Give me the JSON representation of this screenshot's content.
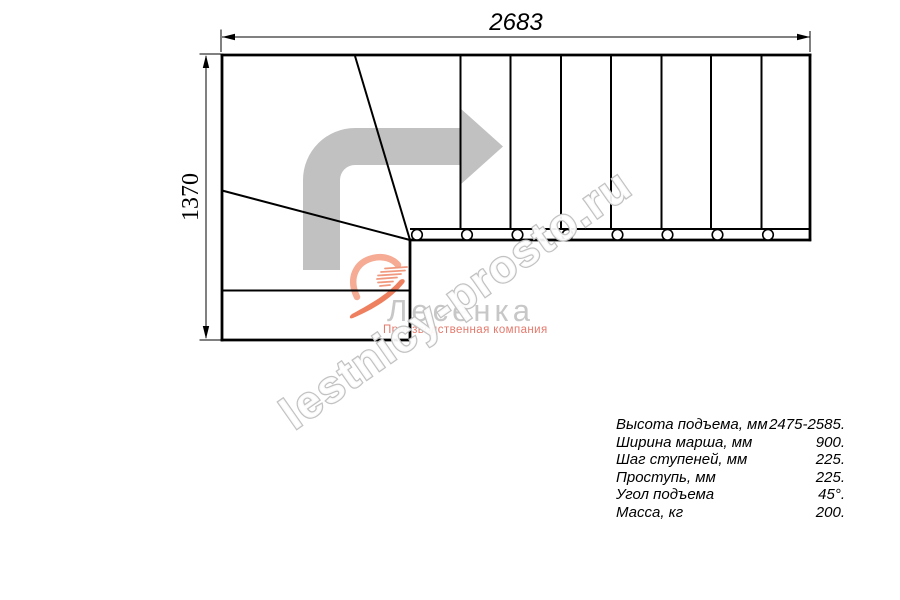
{
  "drawing": {
    "type": "stair-plan-top-view",
    "dimensions": {
      "width_label": "2683",
      "height_label": "1370"
    },
    "straight_treads": 8,
    "winder_treads": 2,
    "baluster_circles": 8
  },
  "watermark": {
    "text": "lestnicy-prosto.ru",
    "color": "#c2c2c2"
  },
  "logo": {
    "name": "Лесенка",
    "tagline": "Производственная компания",
    "name_color": "#c7c7c7",
    "tagline_color": "#e5796c",
    "emblem_light_color": "#f5ab94",
    "emblem_dark_color": "#ee7f5f"
  },
  "direction_arrow_color": "#c1c1c1",
  "line_color": "#000000",
  "specs": {
    "rows": [
      {
        "label": "Высота подъема, мм",
        "value": "2475-2585."
      },
      {
        "label": "Ширина марша, мм",
        "value": "900."
      },
      {
        "label": "Шаг ступеней, мм",
        "value": "225."
      },
      {
        "label": "Проступь, мм",
        "value": "225."
      },
      {
        "label": "Угол подъема",
        "value": "45°."
      },
      {
        "label": "Масса, кг",
        "value": "200."
      }
    ]
  }
}
